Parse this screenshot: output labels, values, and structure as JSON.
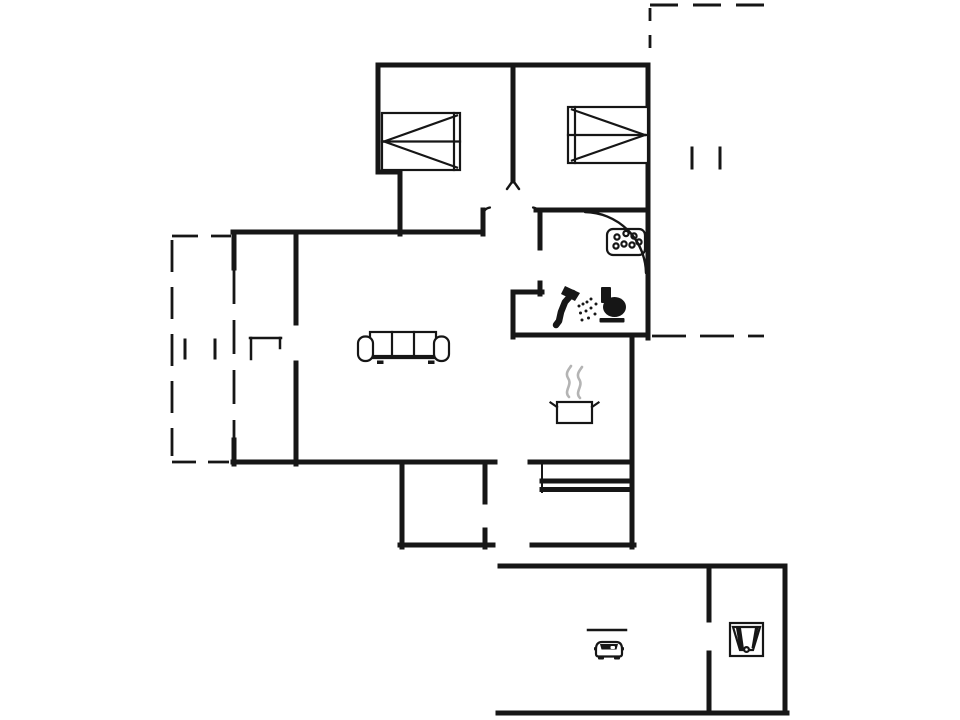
{
  "canvas": {
    "width": 960,
    "height": 720,
    "background": "#ffffff",
    "ink": "#161616",
    "steam": "#b4b4b4"
  },
  "floorplan": {
    "walls": [
      [
        378,
        65,
        648,
        65
      ],
      [
        378,
        65,
        378,
        172
      ],
      [
        378,
        172,
        400,
        172
      ],
      [
        400,
        172,
        400,
        234
      ],
      [
        648,
        65,
        648,
        338
      ],
      [
        513,
        65,
        513,
        181
      ],
      [
        536,
        210,
        648,
        210
      ],
      [
        483,
        210,
        483,
        234
      ],
      [
        233,
        232,
        483,
        232
      ],
      [
        540,
        210,
        540,
        248
      ],
      [
        540,
        283,
        540,
        294
      ],
      [
        513,
        292,
        542,
        292
      ],
      [
        513,
        292,
        513,
        337
      ],
      [
        513,
        335,
        648,
        335
      ],
      [
        632,
        335,
        632,
        547
      ],
      [
        296,
        232,
        296,
        323
      ],
      [
        296,
        363,
        296,
        464
      ],
      [
        234,
        232,
        234,
        268
      ],
      [
        234,
        440,
        234,
        464
      ],
      [
        233,
        462,
        495,
        462
      ],
      [
        530,
        462,
        632,
        462
      ],
      [
        402,
        462,
        402,
        547
      ],
      [
        400,
        545,
        493,
        545
      ],
      [
        485,
        462,
        485,
        502
      ],
      [
        485,
        530,
        485,
        547
      ],
      [
        532,
        545,
        634,
        545
      ],
      [
        542,
        481,
        631,
        481
      ],
      [
        542,
        489.5,
        631,
        489.5
      ],
      [
        500,
        566,
        785,
        566
      ],
      [
        785,
        566,
        785,
        713
      ],
      [
        498,
        713,
        787,
        713
      ],
      [
        709,
        566,
        709,
        620
      ],
      [
        709,
        653,
        709,
        713
      ]
    ],
    "thin_lines": [
      [
        542,
        462,
        542,
        492,
        2
      ],
      [
        588,
        630,
        626,
        630,
        2.5
      ],
      [
        185,
        340,
        185,
        358,
        3
      ],
      [
        215,
        340,
        215,
        358,
        3
      ],
      [
        692,
        148,
        692,
        168,
        3
      ],
      [
        720,
        148,
        720,
        168,
        3
      ],
      [
        251,
        338,
        251,
        359,
        2.5
      ],
      [
        250,
        338,
        281,
        338,
        2.5
      ],
      [
        280,
        338,
        280,
        348,
        2.5
      ]
    ],
    "dashed_lines": [
      [
        172,
        240,
        172,
        456,
        2.8,
        "32 15"
      ],
      [
        234,
        270,
        234,
        438,
        2.8,
        "34 16"
      ],
      [
        172,
        236,
        231,
        236,
        2.8,
        "26 13"
      ],
      [
        172,
        462,
        229,
        462,
        2.8,
        "24 12"
      ],
      [
        650,
        5,
        766,
        5,
        3,
        "28 15"
      ],
      [
        650,
        8,
        650,
        60,
        2.8,
        "13 14"
      ],
      [
        652,
        336,
        764,
        336,
        2.8,
        "34 14"
      ]
    ],
    "paths": [
      {
        "name": "bathroom-door-arc",
        "d": "M 585,212 A 62 62 0 0 1 646,273",
        "w": 2.4
      },
      {
        "name": "wall-end-fork-mark",
        "d": "M 507,189 L 513,180.5 L 519,189",
        "w": 2.4
      },
      {
        "name": "door-jamb-nib-left",
        "d": "M 483,215 Q 483.5,208.5 490,207.5",
        "w": 2.2
      },
      {
        "name": "door-jamb-nib-right",
        "d": "M 540,215 Q 539.5,208.5 533,207.5",
        "w": 2.2
      }
    ],
    "furniture": {
      "bed_left": {
        "transform": "translate(382,113)"
      },
      "bed_right": {
        "transform": "translate(568,107)"
      },
      "sofa": {
        "transform": "translate(357,330)"
      },
      "washbasin": {
        "transform": "translate(606,228)"
      },
      "shower": {
        "transform": "translate(552,284)"
      },
      "toilet": {
        "transform": "translate(598,286)"
      },
      "cooking_pot": {
        "transform": "translate(549,366)"
      },
      "car": {
        "transform": "translate(595,636)"
      },
      "utility_sink": {
        "transform": "translate(729,622)"
      }
    }
  }
}
